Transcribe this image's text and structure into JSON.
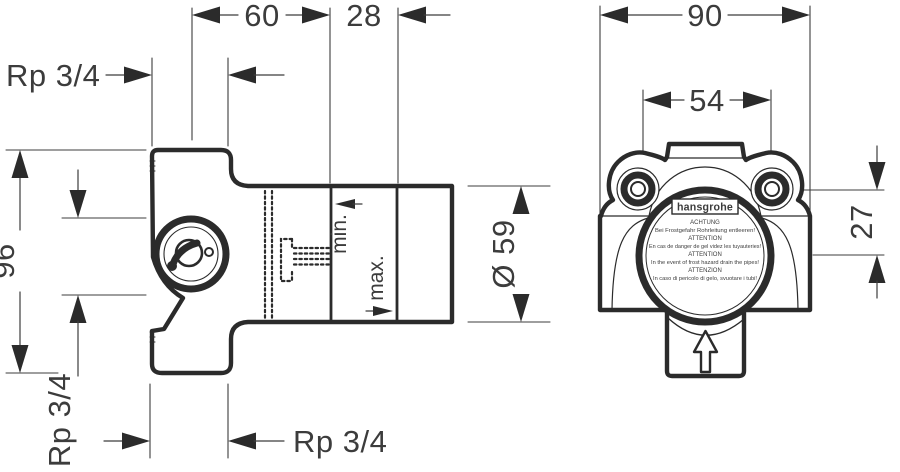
{
  "drawing": {
    "left": {
      "dim_width_front": "60",
      "dim_width_back": "28",
      "port_top": "Rp 3/4",
      "dim_height": "96",
      "port_side": "Rp 3/4",
      "port_bottom": "Rp 3/4",
      "dim_diameter": "Ø 59",
      "label_min": "min.",
      "label_max": "max."
    },
    "right": {
      "dim_width": "90",
      "dim_inner_width": "54",
      "dim_offset": "27",
      "brand": "hansgrohe",
      "warning_lines": [
        "ACHTUNG",
        "Bei Frostgefahr Rohrleitung entleeren!",
        "ATTENTION",
        "En cas de danger de gel videz les tuyauteries!",
        "ATTENTION",
        "In the event of frost hazard drain the pipes!",
        "ATTENZION",
        "In caso di pericolo di gelo, svuotare i tubi!"
      ]
    },
    "colors": {
      "line": "#2b2b2b",
      "text": "#3c3c3c",
      "background": "#ffffff"
    }
  }
}
